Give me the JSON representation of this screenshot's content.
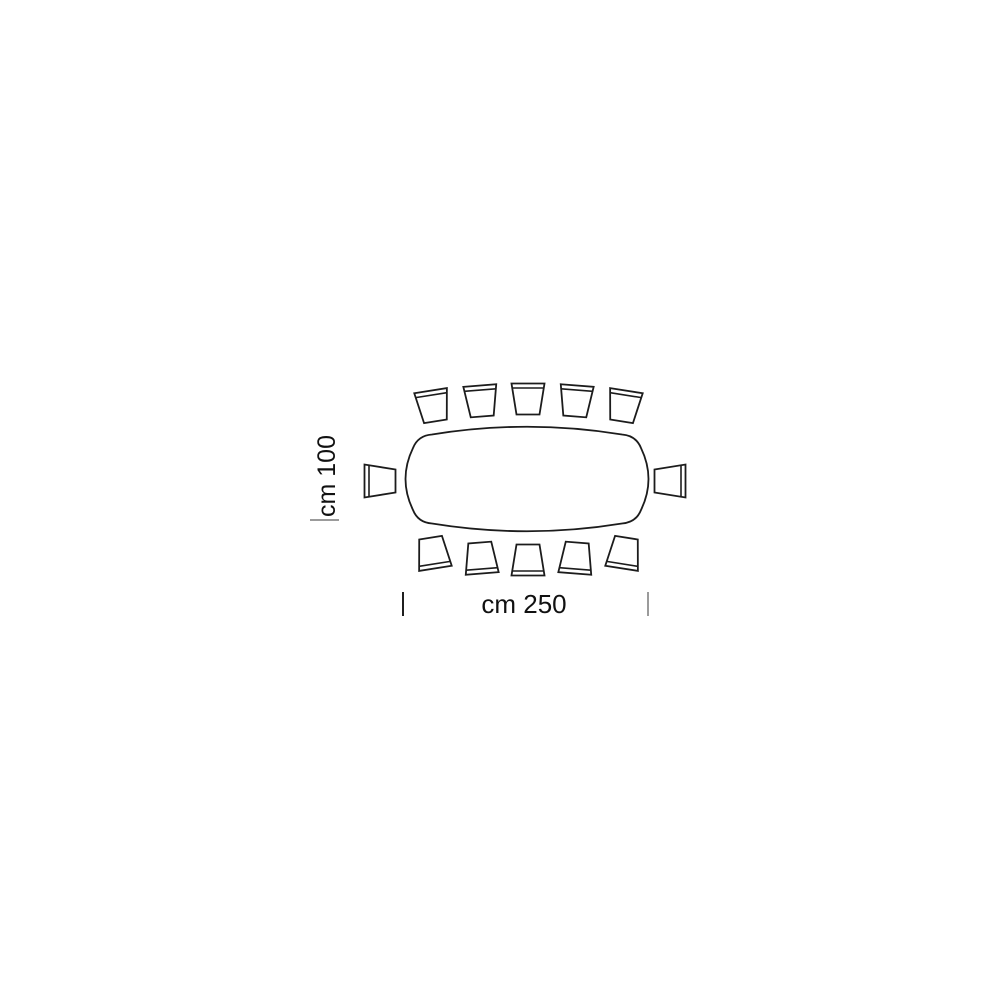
{
  "figure": {
    "type": "furniture-dimension-diagram",
    "subject": "rectangular-table-top-view",
    "width_label": "cm 250",
    "depth_label": "cm 100",
    "seats": {
      "top": 5,
      "bottom": 5,
      "left": 1,
      "right": 1,
      "total": 12
    },
    "colors": {
      "line": "#1c1c1c",
      "tick_dark": "#1f1f1f",
      "tick_gray": "#9b9b9b",
      "background": "#ffffff"
    }
  }
}
